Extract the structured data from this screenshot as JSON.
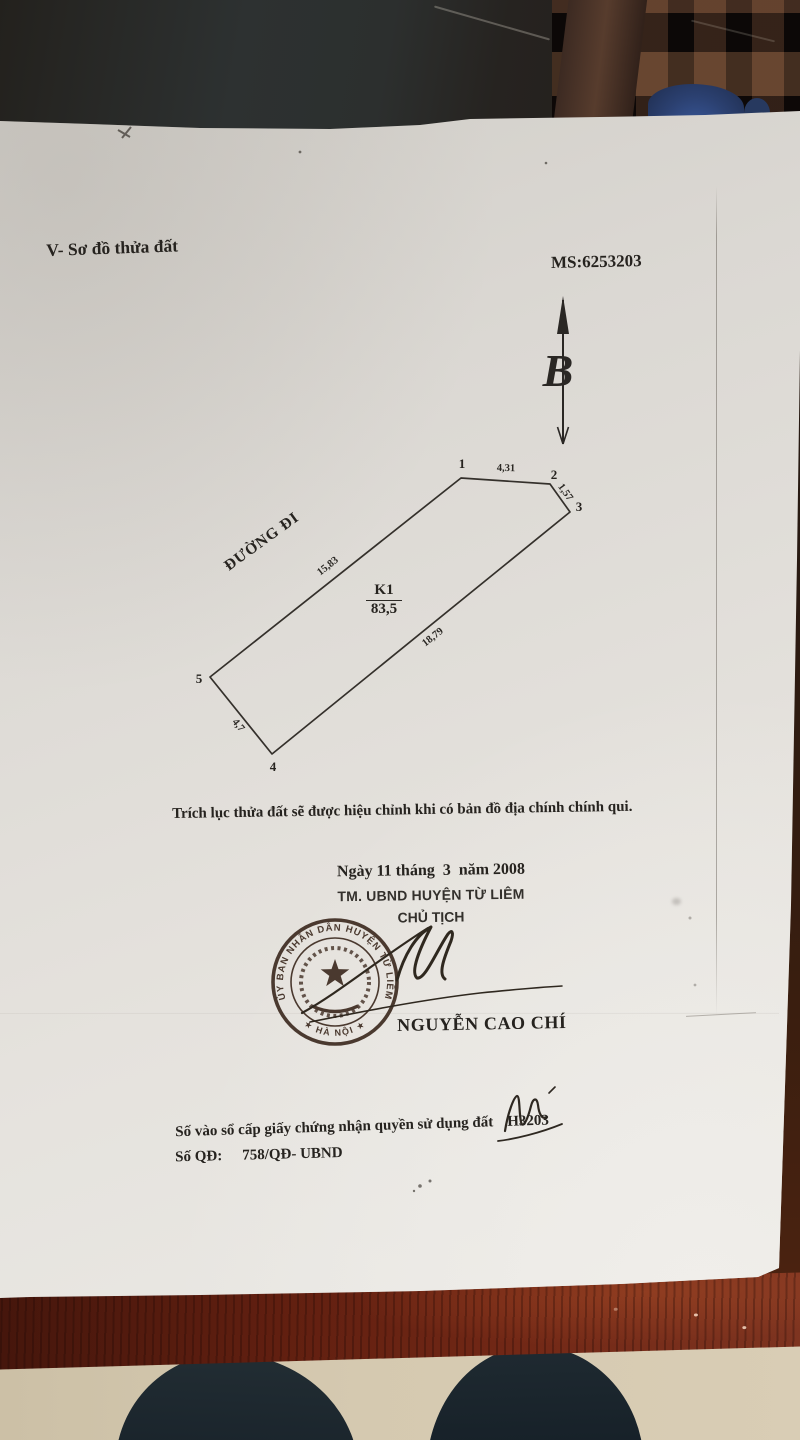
{
  "photo": {
    "scene_colors": {
      "paper": "#e5e2dd",
      "printed_ink": "#26231f",
      "stamp_ink": "#3f2d22",
      "table_wood": "#6b2413",
      "floor": "#d2c6ad",
      "blue_object": "#2b4070"
    }
  },
  "document": {
    "section_title": "V- Sơ đồ thửa đất",
    "ms_code": "MS:6253203",
    "north_arrow_label": "B",
    "diagram": {
      "road_label": "ĐƯỜNG ĐI",
      "parcel_code": "K1",
      "parcel_area": "83,5",
      "vertices": [
        "1",
        "2",
        "3",
        "4",
        "5"
      ],
      "edge_lengths": {
        "v1_v2": "4,31",
        "v2_v3": "1,57",
        "v5_v1": "15,83",
        "v3_v4": "18,79",
        "v4_v5": "4,7"
      }
    },
    "note": "Trích lục thửa đất sẽ được hiệu chỉnh khi có bản đồ địa chính chính qui.",
    "issuance": {
      "date_line": "Ngày 11 tháng  3  năm 2008",
      "authority_line": "TM. UBND HUYỆN TỪ LIÊM",
      "signer_title": "CHỦ TỊCH",
      "signer_name": "NGUYỄN CAO CHÍ",
      "handwritten_initial": "Mai"
    },
    "stamp": {
      "ring_text": "ỦY BAN NHÂN DÂN HUYỆN TỪ LIÊM",
      "bottom_text": "★ HÀ NỘI ★"
    },
    "registry": {
      "book_entry_label": "Số vào sổ cấp giấy chứng nhận quyền sử dụng đất",
      "book_entry_number": "H3203",
      "decision_label": "Số QĐ:",
      "decision_number": "758/QĐ- UBND"
    }
  }
}
